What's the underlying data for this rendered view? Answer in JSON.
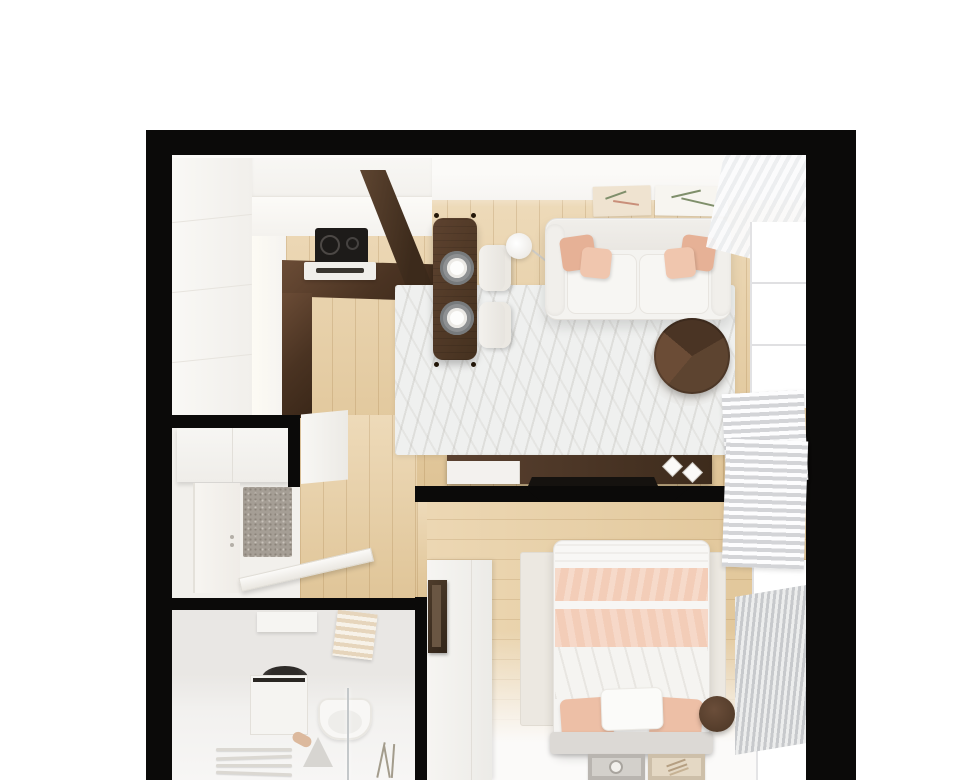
{
  "title": "apartment-floor-plan-3d-render",
  "colors": {
    "bg": "#ffffff",
    "wall": "#0b0a09",
    "interior": "#f5f3f0",
    "oak": "#e7cc9e",
    "walnut": "#4a3322",
    "white-furniture": "#f5f4f1",
    "blush": "#edbfa6",
    "pink": "#f3cdb8",
    "rug-living": "#eff0ef",
    "rug-bedroom": "#ece8e1",
    "doormat": "#a59e95",
    "curtain": "#d3d4d7",
    "tv": "#0b0a09",
    "cooktop": "#1d1b19"
  },
  "scene": {
    "type": "top-down-apartment-render",
    "rooms": [
      {
        "name": "kitchen-living-room",
        "furniture": [
          "kitchen-cabinets",
          "countertop",
          "cooktop",
          "oven",
          "tall-cabinet-panel",
          "dining-table",
          "dining-chairs",
          "plates",
          "sofa",
          "throw-pillows",
          "floor-lamp",
          "area-rug",
          "coffee-table",
          "wall-art",
          "media-console",
          "decor-diamonds",
          "tv",
          "window",
          "curtains"
        ]
      },
      {
        "name": "hallway",
        "furniture": [
          "wardrobe",
          "hall-cabinet",
          "entry-door",
          "doormat",
          "open-interior-door"
        ]
      },
      {
        "name": "bathroom",
        "furniture": [
          "washing-machine",
          "toilet",
          "shower-glass",
          "shower-tray",
          "towel-rack",
          "towel-ladder",
          "slipper",
          "plant"
        ]
      },
      {
        "name": "bedroom",
        "furniture": [
          "double-bed",
          "pillows",
          "duvet",
          "headboard",
          "bedside-table",
          "dresser",
          "mirror",
          "wall-frames",
          "tv",
          "radiator",
          "window",
          "curtains",
          "area-rug"
        ]
      }
    ],
    "counts": {
      "plates": 2,
      "dining_chairs": 2,
      "sofa_pillows": 4,
      "bed_pillows": 3,
      "posters": 2,
      "bedroom_frames": 2,
      "windows": 2
    }
  }
}
